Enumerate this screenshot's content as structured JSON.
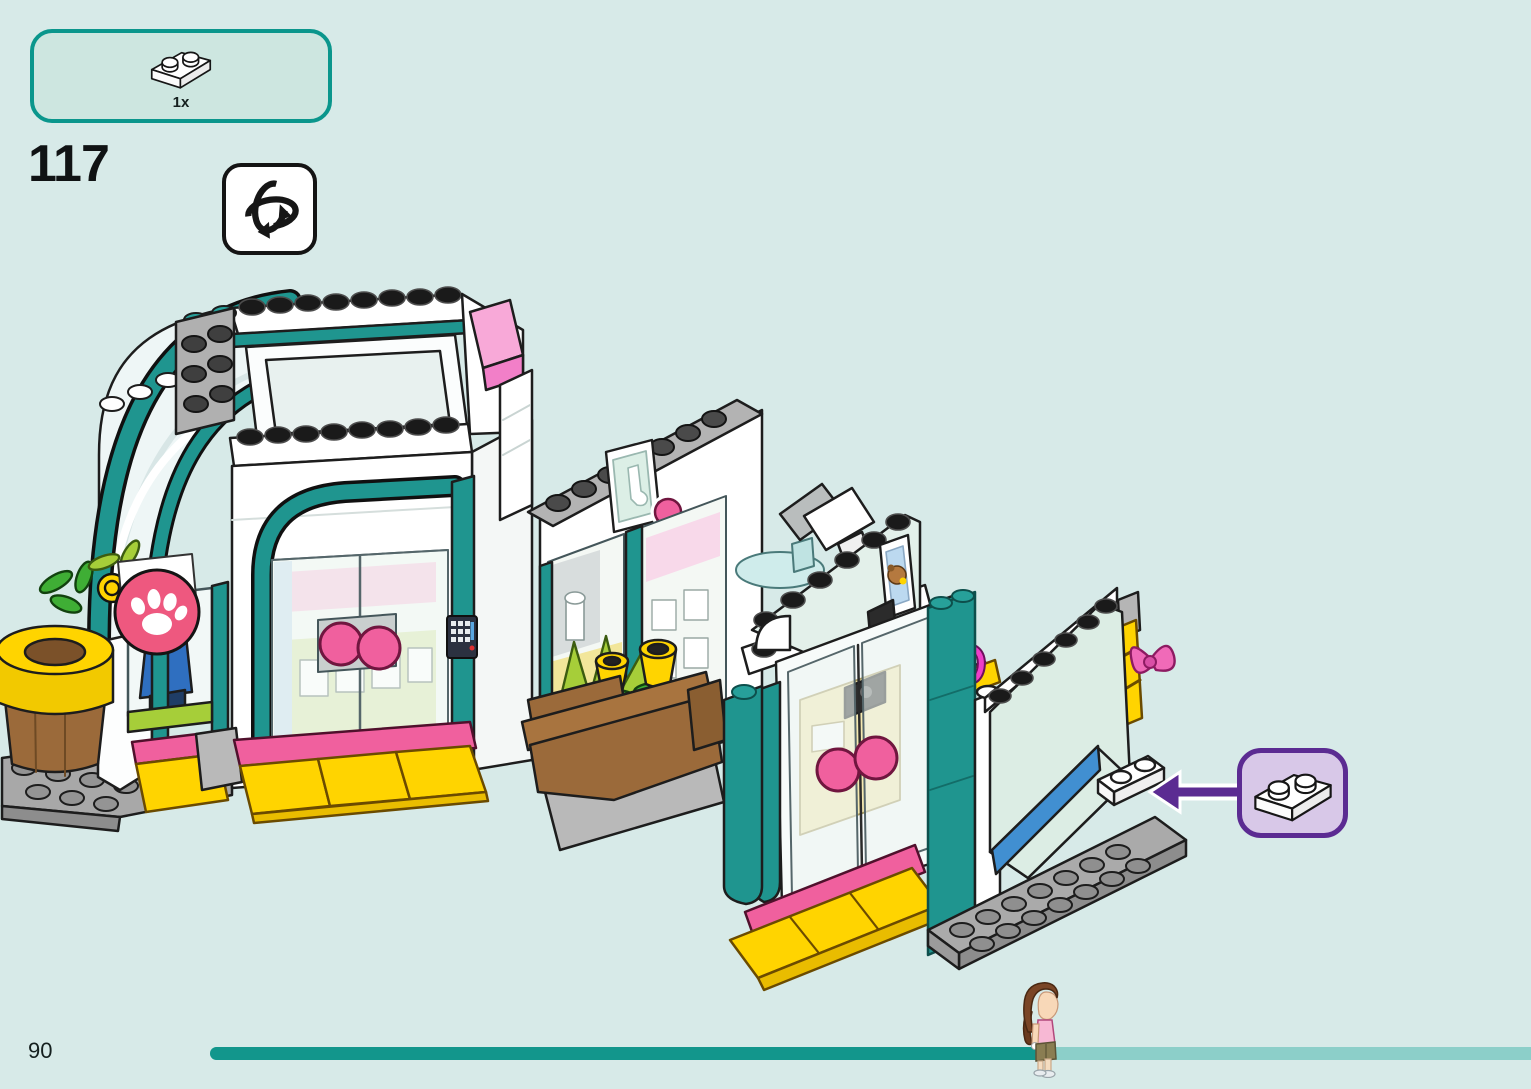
{
  "page": {
    "background_color": "#d7eae8",
    "step_number": "117",
    "page_number": "90"
  },
  "parts_panel": {
    "piece": "white-plate-1x2",
    "count_label": "1x",
    "border_color": "#0a968c",
    "fill_color": "#cde6e0"
  },
  "rotate_indicator": {
    "icon": "rotate-model-icon"
  },
  "callout": {
    "piece": "white-plate-1x2",
    "arrow_direction": "left",
    "border_color": "#5b2b92",
    "fill_color": "#d8c8e8",
    "arrow_color": "#5b2b92"
  },
  "progress": {
    "fill_percent": "63%",
    "bar_color": "#12968c",
    "track_color": "#8ccfc9",
    "marker": "minidoll-figure"
  },
  "illustration": {
    "subject": "LEGO Friends shopping street building, isometric step view",
    "accent_colors": {
      "teal": "#1f958f",
      "pink": "#f0609e",
      "paw_sign": "#ee587f",
      "yellow": "#ffd400",
      "magenta": "#ee3ec8",
      "blue_stripe": "#418fd1",
      "lime": "#a6ce39",
      "brown": "#9b6a3a"
    }
  }
}
